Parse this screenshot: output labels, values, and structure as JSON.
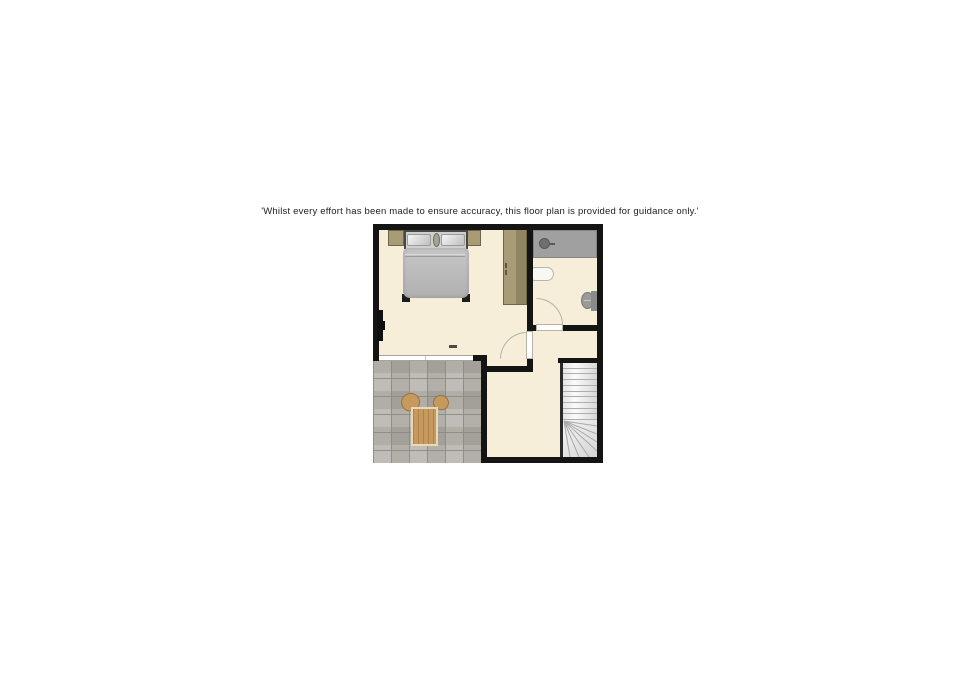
{
  "disclaimer": {
    "text": "'Whilst every effort has been made to ensure accuracy, this floor plan is provided for guidance only.'"
  },
  "floorplan": {
    "type": "floor-plan",
    "rooms": [
      {
        "name": "bedroom",
        "items": [
          "double-bed",
          "pillow",
          "pillow",
          "bedside-unit",
          "bedside-unit",
          "wardrobe",
          "tv"
        ]
      },
      {
        "name": "bathroom",
        "items": [
          "shower",
          "washbasin",
          "toilet",
          "door"
        ]
      },
      {
        "name": "landing",
        "items": [
          "staircase",
          "door"
        ]
      },
      {
        "name": "terrace",
        "items": [
          "tiled-floor",
          "table",
          "chair",
          "chair",
          "window"
        ]
      }
    ],
    "colors": {
      "wall": "#141414",
      "floor": "#f6eed9",
      "tile_base": "#b6b3ac",
      "tile_grout": "#98948c",
      "wood": "#c6995f",
      "wood_light": "#e8d8b6",
      "tan": "#a89c76",
      "tan_dark": "#8f8560",
      "duvet": "#b7b7b7",
      "headboard": "#474747",
      "shower": "#a0a0a0",
      "fixture": "#9a9a9a",
      "stair_line": "#aeaeae",
      "door_line": "#b7b2a8",
      "window_line": "#a8a49c",
      "text": "#1e1e1e"
    }
  }
}
